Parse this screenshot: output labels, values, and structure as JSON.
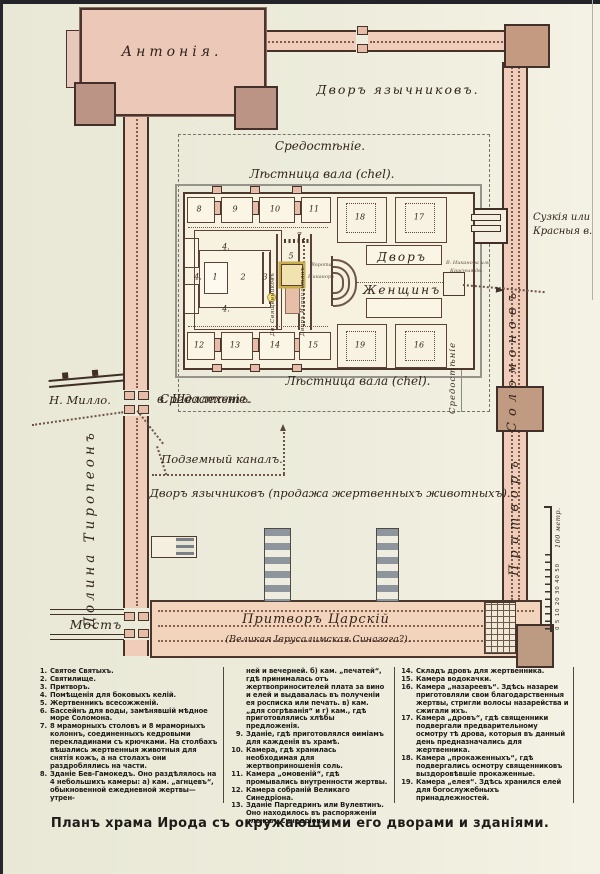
{
  "page": {
    "caption": "Планъ храма Ирода съ окружающими его дворами и зданіями."
  },
  "map": {
    "antonia": "Антонія.",
    "court_gentiles_top": "Дворъ язычниковъ.",
    "sredostenie_top": "Средостѣніе.",
    "chel_top": "Лѣстница вала (chel).",
    "chel_bottom": "Лѣстница вала (chel).",
    "sredostenie_bottom": "Средостѣніе.",
    "sredostenie_right_vertical": "Средостѣніе",
    "womens_court_line1": "Дворъ",
    "womens_court_line2": "Женщинъ",
    "nicanor_line1": "Ворота",
    "nicanor_line2": "Никанора",
    "court_priests_vertical": "Дв. Священниковъ",
    "court_israelites_vertical": "Дворъ Израильтянъ",
    "east_gate_line1": "В. Никанора или",
    "east_gate_line2": "Красныя дв.",
    "shushan_gate_line1": "Сузкія или",
    "shushan_gate_line2": "Красныя в.",
    "solomon_vertical": "Соломоновъ",
    "porch_vertical": "Притворъ",
    "millo": "Н. Милло.",
    "shellechet": "в. Шеллехетъ.",
    "underground_canal": "Подземный каналъ.",
    "court_gentiles_bottom": "Дворъ язычниковъ (продажа жертвенныхъ животныхъ).",
    "tyropoeon_valley": "Долина Тиропеонъ",
    "bridge": "Мостъ",
    "royal_porch": "Притворъ Царскій",
    "royal_porch_sub": "(Великая Іерусалимская Синагога?).",
    "scale_numbers": "0 5 10 20 30 40 50",
    "scale_label": "100 метр.",
    "room_numbers": [
      {
        "n": "8",
        "x": 199,
        "y": 209
      },
      {
        "n": "9",
        "x": 235,
        "y": 209
      },
      {
        "n": "10",
        "x": 275,
        "y": 209
      },
      {
        "n": "11",
        "x": 314,
        "y": 209
      },
      {
        "n": "18",
        "x": 360,
        "y": 217
      },
      {
        "n": "17",
        "x": 419,
        "y": 217
      },
      {
        "n": "12",
        "x": 199,
        "y": 345
      },
      {
        "n": "13",
        "x": 235,
        "y": 345
      },
      {
        "n": "14",
        "x": 275,
        "y": 345
      },
      {
        "n": "15",
        "x": 313,
        "y": 345
      },
      {
        "n": "19",
        "x": 360,
        "y": 345
      },
      {
        "n": "16",
        "x": 419,
        "y": 345
      },
      {
        "n": "1",
        "x": 215,
        "y": 277
      },
      {
        "n": "2",
        "x": 243,
        "y": 277
      },
      {
        "n": "3",
        "x": 265,
        "y": 277
      },
      {
        "n": "4.",
        "x": 226,
        "y": 247
      },
      {
        "n": "4.",
        "x": 198,
        "y": 277
      },
      {
        "n": "4.",
        "x": 226,
        "y": 309
      },
      {
        "n": "5",
        "x": 291,
        "y": 256
      },
      {
        "n": "7",
        "x": 299,
        "y": 236
      }
    ]
  },
  "legend": {
    "columns": [
      {
        "items": [
          {
            "num": "1.",
            "text": "Святое Святыхъ."
          },
          {
            "num": "2.",
            "text": "Святилище."
          },
          {
            "num": "3.",
            "text": "Притворъ."
          },
          {
            "num": "4.",
            "text": "Помѣщенія для боковыхъ келій."
          },
          {
            "num": "5.",
            "text": "Жертвенникъ всесожженій."
          },
          {
            "num": "6.",
            "text": "Бассейнъ для воды, замѣнявшій мѣдное море Соломона."
          },
          {
            "num": "7.",
            "text": "8 мраморныхъ столовъ и 8 мраморныхъ колоннъ, соединенныхъ кедровыми перекладинами съ крючками. На столбахъ вѣшались жертвенныя животныя для снятія кожъ, а на столахъ они раздроблялись на части."
          },
          {
            "num": "8.",
            "text": "Зданіе Бев-Гамокедъ. Оно раздѣлялось на 4 небольшихъ камеры: а) кам. „агнцевъ“, обыкновенной ежедневной жертвы—утрен-"
          }
        ]
      },
      {
        "items": [
          {
            "num": "",
            "text": "ней и вечерней. б) кам. „печатей“, гдѣ принималась отъ жертвоприносителей плата за вино и елей и выдавалась въ полученіи ея росписка или печать. в) кам. „для согрѣванія“ и г) кам., гдѣ приготовлялись хлѣбы предложенія."
          },
          {
            "num": "9.",
            "text": "Зданіе, гдѣ приготовлялся ѳиміамъ для кажденія въ храмѣ."
          },
          {
            "num": "10.",
            "text": "Камера, гдѣ хранилась необходимая для жертвоприношенія соль."
          },
          {
            "num": "11.",
            "text": "Камера „омовеній“, гдѣ промывались внутренности жертвы."
          },
          {
            "num": "12.",
            "text": "Камера собраній Великаго Синедріона."
          },
          {
            "num": "13.",
            "text": "Зданіе Паргедринъ или Вулевтинъ. Оно находилось въ распоряженіи членовъ Синедріона."
          }
        ]
      },
      {
        "items": [
          {
            "num": "14.",
            "text": "Складъ дровъ для жертвенника."
          },
          {
            "num": "15.",
            "text": "Камера водокачки."
          },
          {
            "num": "16.",
            "text": "Камера „назареевъ“. Здѣсь назареи приготовляли свои благодарственныя жертвы, стригли волосы назарейства и сжигали ихъ."
          },
          {
            "num": "17.",
            "text": "Камера „дровъ“, гдѣ священники подвергали предварительному осмотру тѣ дрова, которыя въ данный день предназначались для жертвенника."
          },
          {
            "num": "18.",
            "text": "Камера „прокаженныхъ“, гдѣ подвергались осмотру священниковъ выздоровѣвшіе прокаженные."
          },
          {
            "num": "19.",
            "text": "Камера „елея“. Здѣсь хранился елей для богослужебныхъ принадлежностей."
          }
        ]
      }
    ]
  }
}
